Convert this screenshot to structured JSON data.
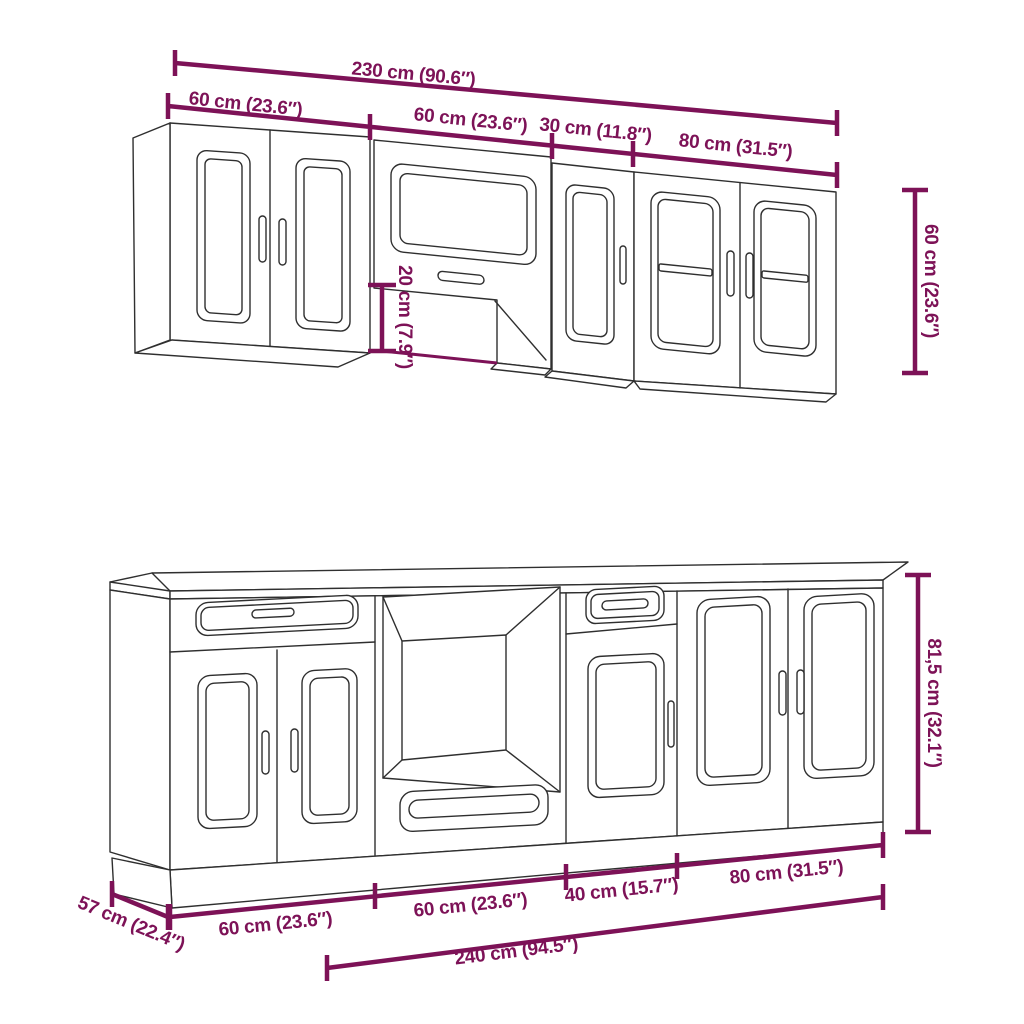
{
  "diagram_type": "kitchen-cabinet-set-dimension-diagram",
  "colors": {
    "dimension": "#7d1257",
    "outline": "#2f2f2f",
    "background": "#ffffff"
  },
  "wall_unit": {
    "total_width": "230 cm (90.6″)",
    "segment_widths": [
      "60 cm (23.6″)",
      "60 cm (23.6″)",
      "30 cm (11.8″)",
      "80 cm (31.5″)"
    ],
    "cabinet_height": "60 cm (23.6″)",
    "hood_section_height": "20 cm (7.9″)"
  },
  "base_unit": {
    "total_width": "240 cm (94.5″)",
    "segment_widths": [
      "60 cm (23.6″)",
      "60 cm (23.6″)",
      "40 cm (15.7″)",
      "80 cm (31.5″)"
    ],
    "cabinet_height": "81,5 cm (32.1″)",
    "depth": "57 cm (22.4″)"
  }
}
